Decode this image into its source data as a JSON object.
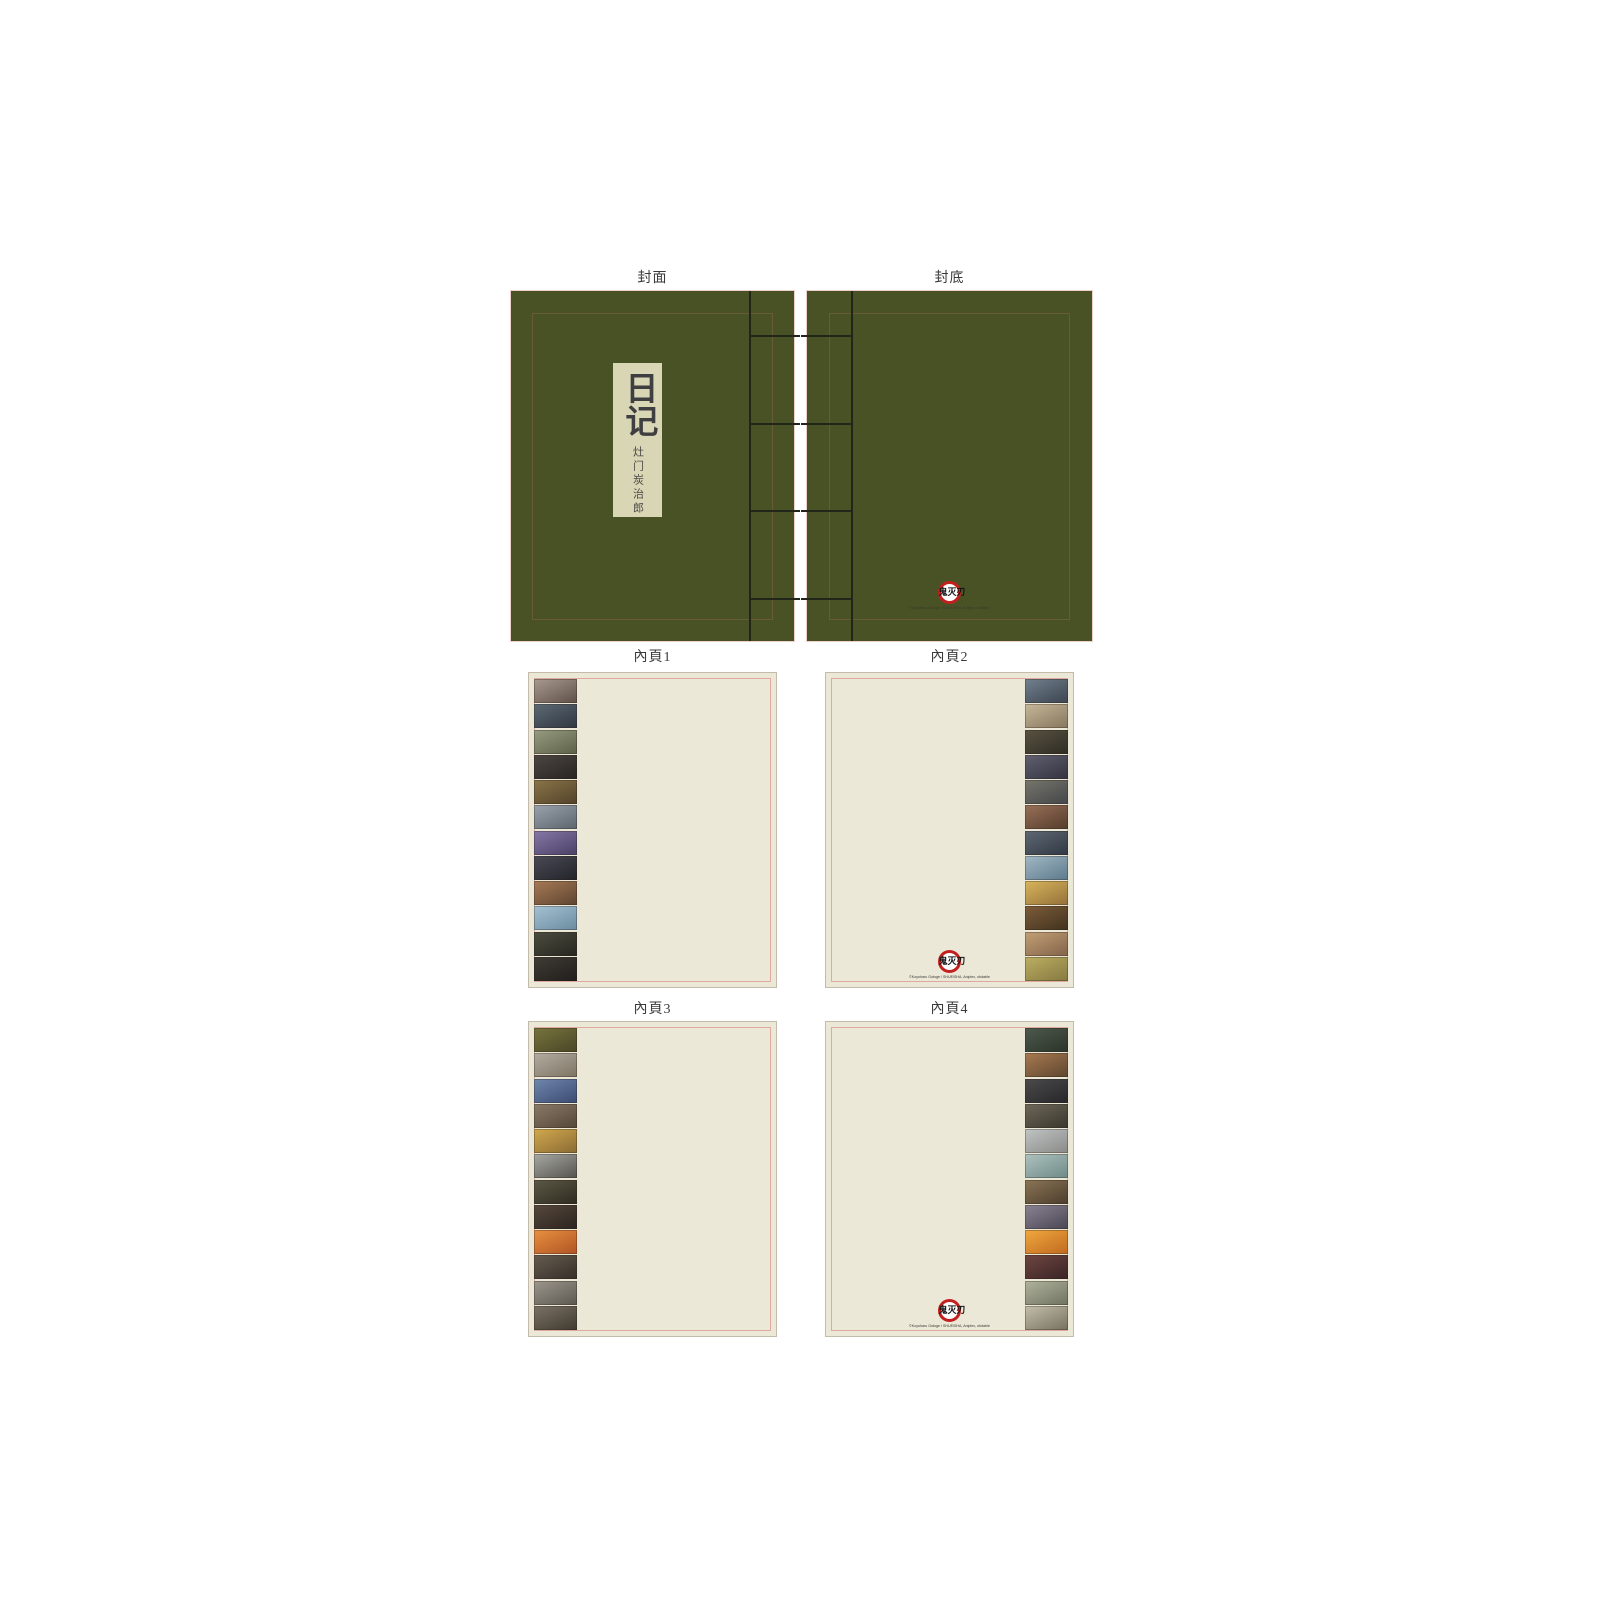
{
  "colors": {
    "cover_green": "#495224",
    "cover_inner_border": "#6f5d3c",
    "stitch_line": "#22251a",
    "title_slip_bg": "#d9d6b5",
    "title_text": "#3f3f42",
    "sheet_label_text": "#3a3a3a",
    "page_bg": "#ebe8d8",
    "page_border": "#c4bbaa",
    "page_inner_line": "#dfa9a0",
    "logo_ring_red": "#c41f1f",
    "logo_text_black": "#131313"
  },
  "covers": {
    "front": {
      "label": "封面",
      "title": "日记",
      "subtitle": "灶门炭治郎"
    },
    "back": {
      "label": "封底"
    }
  },
  "logo": {
    "text": "鬼灭刃",
    "copyright": "©Koyoharu Gotoge / SHUEISHA, Aniplex, ufotable"
  },
  "pages": [
    {
      "label": "內頁1",
      "strip_side": "left",
      "has_logo": false,
      "frames": [
        {
          "desc": "two-kimono-figures-light-scene",
          "c1": "#a89a90",
          "c2": "#5f4f49"
        },
        {
          "desc": "tanjiro-closeup-teal-dark",
          "c1": "#5c6a74",
          "c2": "#303640"
        },
        {
          "desc": "village-outdoor-green",
          "c1": "#969c80",
          "c2": "#5c6048"
        },
        {
          "desc": "dark-scene-faint-circle",
          "c1": "#4c4642",
          "c2": "#282422"
        },
        {
          "desc": "red-fox-mask-forest",
          "c1": "#8a7448",
          "c2": "#52422a"
        },
        {
          "desc": "rainy-gray-doorway",
          "c1": "#9aa2ac",
          "c2": "#5c646e"
        },
        {
          "desc": "purple-flashback-figure",
          "c1": "#8678a6",
          "c2": "#4a4066"
        },
        {
          "desc": "white-mask-dark-girl",
          "c1": "#4a4a56",
          "c2": "#232329"
        },
        {
          "desc": "warm-brown-tanjiro-face",
          "c1": "#a67a56",
          "c2": "#5e4430"
        },
        {
          "desc": "blue-sky-boys",
          "c1": "#a6c2d2",
          "c2": "#6a8ba0"
        },
        {
          "desc": "dark-room-checkered-haori",
          "c1": "#4c4c40",
          "c2": "#27261f"
        },
        {
          "desc": "very-dark-frame",
          "c1": "#403c36",
          "c2": "#201e1b"
        }
      ]
    },
    {
      "label": "內頁2",
      "strip_side": "right",
      "has_logo": true,
      "frames": [
        {
          "desc": "tanjiro-grin-blue-gray",
          "c1": "#72808e",
          "c2": "#3c4450"
        },
        {
          "desc": "light-scene-crow-figures",
          "c1": "#c6b79a",
          "c2": "#86765c"
        },
        {
          "desc": "urokodaki-hat-dark",
          "c1": "#5a5242",
          "c2": "#2e2c24"
        },
        {
          "desc": "tamayo-dark-portrait",
          "c1": "#60606e",
          "c2": "#343240"
        },
        {
          "desc": "gray-portrait-pair",
          "c1": "#76766c",
          "c2": "#44464a"
        },
        {
          "desc": "tanjiro-warm-closeup",
          "c1": "#987058",
          "c2": "#543c2c"
        },
        {
          "desc": "giyu-dark-blue-snow",
          "c1": "#5e6872",
          "c2": "#303844"
        },
        {
          "desc": "sky-tanjiro-wood-box",
          "c1": "#a2b8c4",
          "c2": "#5c7a8c"
        },
        {
          "desc": "zenitsu-yellow-tanjiro",
          "c1": "#d8b55c",
          "c2": "#94703a"
        },
        {
          "desc": "warm-interior-tanjiro",
          "c1": "#7c5c3a",
          "c2": "#42321e"
        },
        {
          "desc": "inosuke-tan-figure",
          "c1": "#c2a075",
          "c2": "#83634a"
        },
        {
          "desc": "yellow-green-pattern",
          "c1": "#bcae62",
          "c2": "#857940"
        }
      ]
    },
    {
      "label": "內頁3",
      "strip_side": "left",
      "has_logo": false,
      "frames": [
        {
          "desc": "green-brown-action-scene",
          "c1": "#77743e",
          "c2": "#4a4526"
        },
        {
          "desc": "gray-round-creature",
          "c1": "#b3aca1",
          "c2": "#7e7463"
        },
        {
          "desc": "zenitsu-blue-background",
          "c1": "#6f87ac",
          "c2": "#3c4a72"
        },
        {
          "desc": "brown-figures-pair",
          "c1": "#8a7a68",
          "c2": "#544638"
        },
        {
          "desc": "zenitsu-bright-yellow",
          "c1": "#d2a94e",
          "c2": "#8a6a34"
        },
        {
          "desc": "pale-white-haired-figure",
          "c1": "#a8a8a4",
          "c2": "#55544e"
        },
        {
          "desc": "dark-demon-figure",
          "c1": "#5c5846",
          "c2": "#2e2c20"
        },
        {
          "desc": "tanjiro-dark-shocked",
          "c1": "#56483c",
          "c2": "#2c2420"
        },
        {
          "desc": "orange-scream-scene",
          "c1": "#e89040",
          "c2": "#b05424"
        },
        {
          "desc": "inosuke-boar-head-dark",
          "c1": "#665c50",
          "c2": "#362f28"
        },
        {
          "desc": "gray-white-demon",
          "c1": "#9c968c",
          "c2": "#5c5850"
        },
        {
          "desc": "boar-mask-closeup",
          "c1": "#7a7264",
          "c2": "#403a30"
        }
      ]
    },
    {
      "label": "內頁4",
      "strip_side": "right",
      "has_logo": true,
      "frames": [
        {
          "desc": "dark-rain-green-haori",
          "c1": "#4e5a4e",
          "c2": "#2a3328"
        },
        {
          "desc": "zenitsu-tanjiro-warm-closeup",
          "c1": "#a87a50",
          "c2": "#5e4630"
        },
        {
          "desc": "giyu-dark-portrait",
          "c1": "#4c4a4a",
          "c2": "#26262a"
        },
        {
          "desc": "sleeping-pale-face",
          "c1": "#6e685a",
          "c2": "#3a362c"
        },
        {
          "desc": "tanjiro-snow-blossom",
          "c1": "#c0c4c4",
          "c2": "#8a8a88"
        },
        {
          "desc": "shinobu-by-water",
          "c1": "#aec2be",
          "c2": "#6e8a88"
        },
        {
          "desc": "dark-tan-demon",
          "c1": "#8a7456",
          "c2": "#4c3e2c"
        },
        {
          "desc": "pale-lavender-figure",
          "c1": "#8a8292",
          "c2": "#4a4654"
        },
        {
          "desc": "inosuke-orange-surprised",
          "c1": "#f0a83e",
          "c2": "#c06a20"
        },
        {
          "desc": "kanao-dark-red-scene",
          "c1": "#6e4640",
          "c2": "#3a2426"
        },
        {
          "desc": "light-scene-two-figures",
          "c1": "#b0b49e",
          "c2": "#6e7260"
        },
        {
          "desc": "kanao-portrait-light",
          "c1": "#c4bead",
          "c2": "#76705e"
        }
      ]
    }
  ]
}
